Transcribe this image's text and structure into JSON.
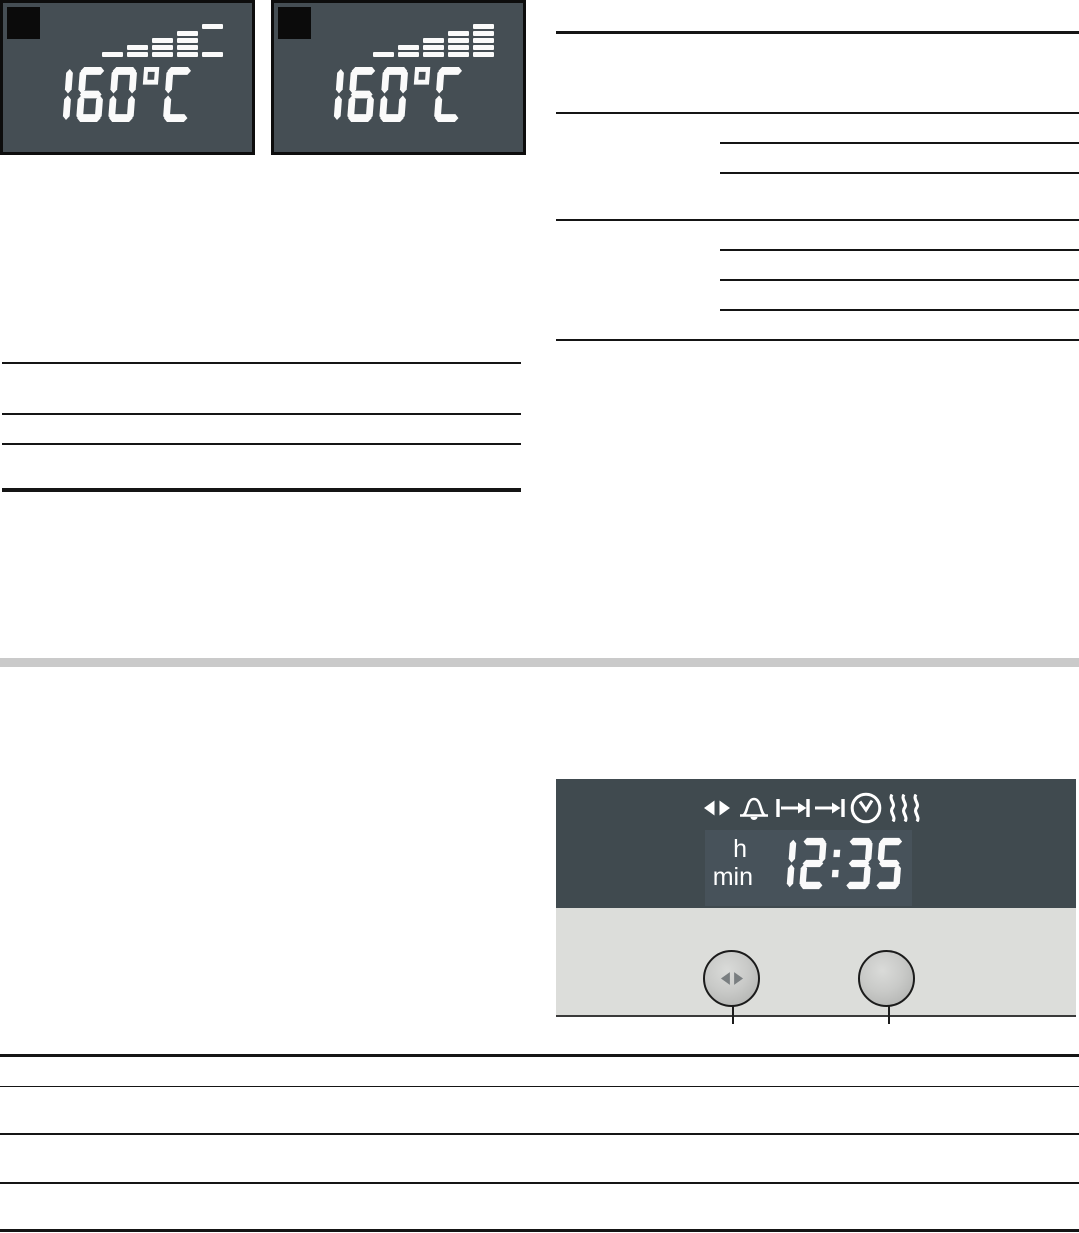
{
  "page_type": "appliance-manual-page",
  "lcd_displays": [
    {
      "label": "temperature-display-heating-up",
      "temperature": "160°C",
      "heat_up_indicator": {
        "rows": 5,
        "columns": [
          [
            5
          ],
          [
            4,
            5
          ],
          [
            3,
            4,
            5
          ],
          [
            2,
            3,
            4,
            5
          ],
          [
            1,
            5
          ]
        ]
      }
    },
    {
      "label": "temperature-display-fully-heated",
      "temperature": "160°C",
      "heat_up_indicator": {
        "rows": 5,
        "columns": [
          [
            5
          ],
          [
            4,
            5
          ],
          [
            3,
            4,
            5
          ],
          [
            2,
            3,
            4,
            5
          ],
          [
            1,
            2,
            3,
            4,
            5
          ]
        ]
      }
    }
  ],
  "control_panel": {
    "display": {
      "icons": [
        "select-arrows",
        "timer-bell",
        "cooking-time",
        "end-time",
        "clock",
        "heat-waves"
      ],
      "hour_label": "h",
      "minute_label": "min",
      "time": "12:35"
    },
    "buttons": [
      {
        "name": "select-button",
        "glyph": "select-arrows"
      },
      {
        "name": "plain-button",
        "glyph": ""
      }
    ]
  },
  "colors": {
    "lcd_background": "#454e54",
    "lcd_border": "#0d0d0d",
    "lcd_segments": "#fafafa",
    "corner_marker": "#0b0b0b",
    "panel_display_background": "#404a4f",
    "panel_display_inner": "#47525a",
    "panel_body_background": "#dcddda",
    "section_divider": "#cacaca",
    "rule_color": "#151515"
  }
}
